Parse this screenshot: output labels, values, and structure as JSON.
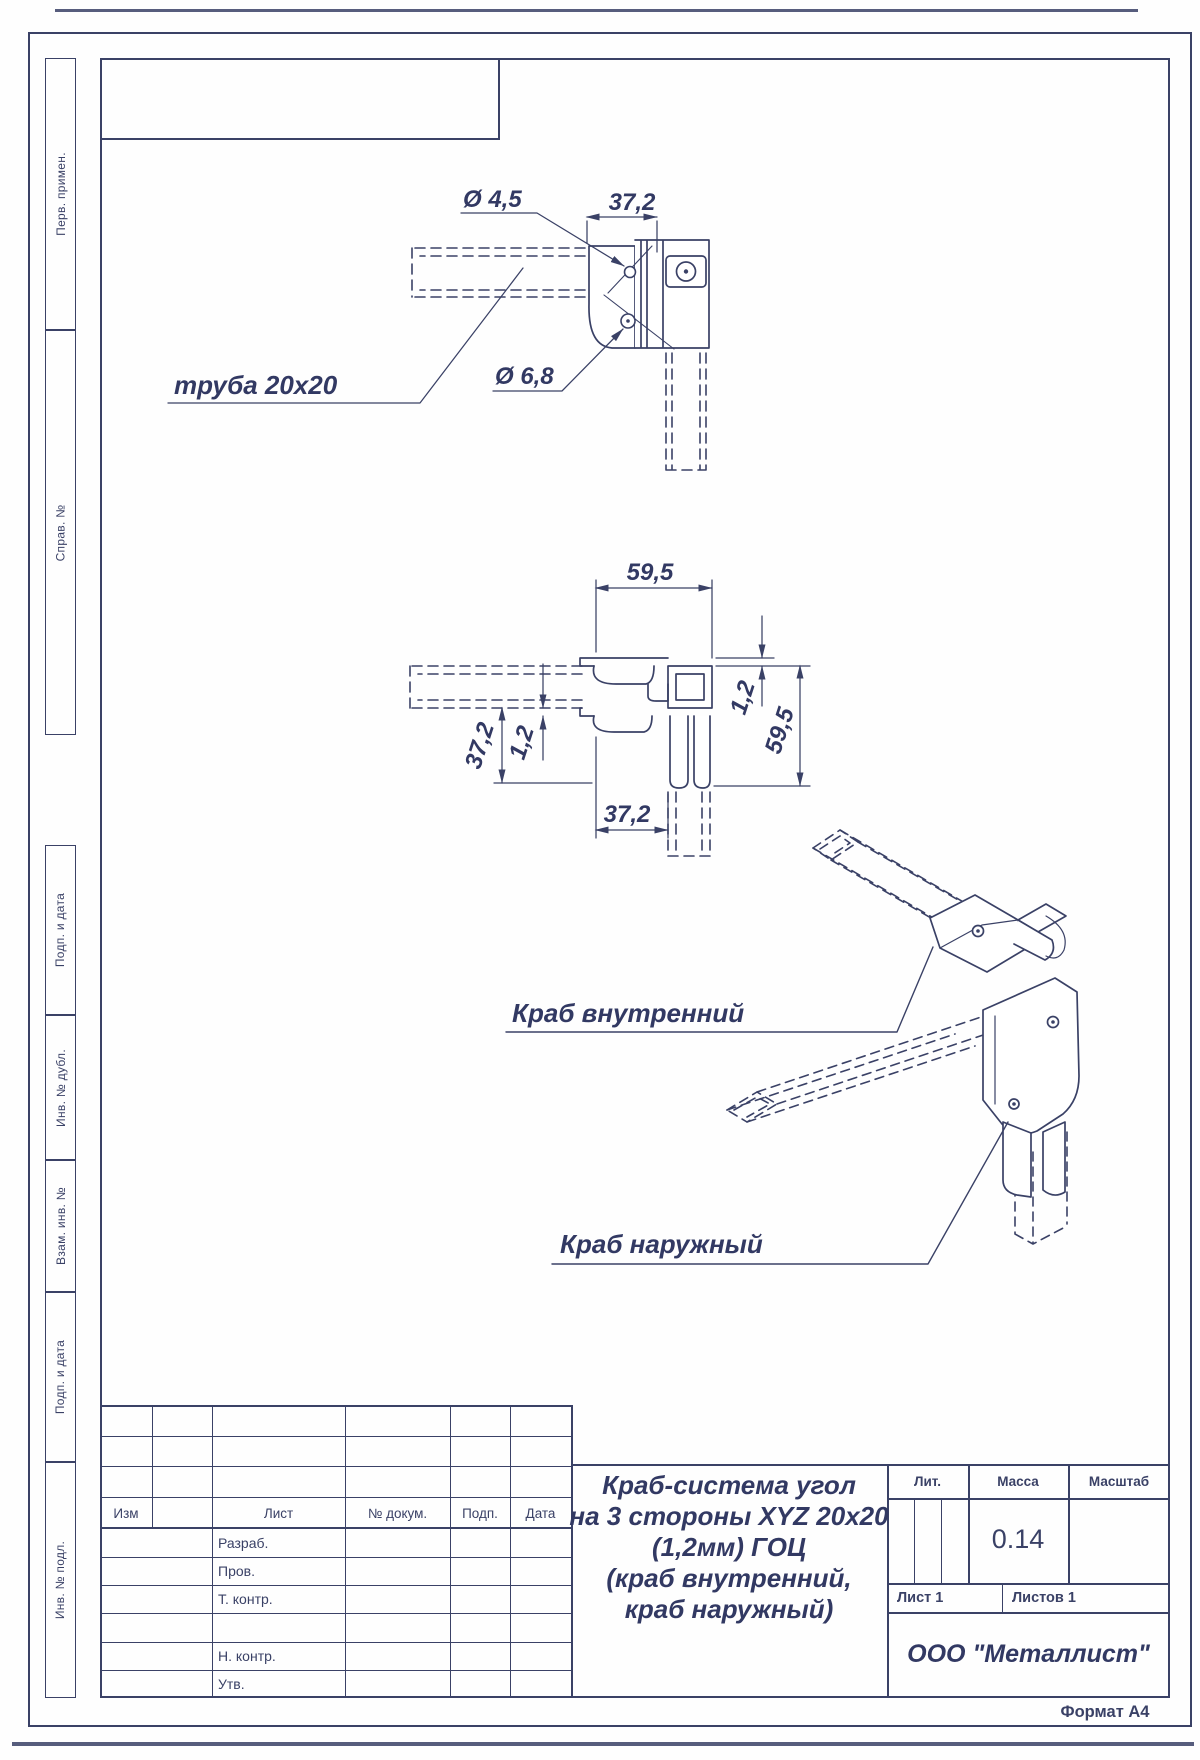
{
  "colors": {
    "ink": "#3a4166"
  },
  "margin_labels": [
    "Перв. примен.",
    "Справ. №",
    "Подп. и дата",
    "Инв. № дубл.",
    "Взам. инв. №",
    "Подп. и дата",
    "Инв. № подл."
  ],
  "views": {
    "top": {
      "dim_hole_small": "Ø 4,5",
      "dim_width": "37,2",
      "dim_hole_large": "Ø 6,8",
      "tube_label": "труба 20x20"
    },
    "section": {
      "dim_top": "59,5",
      "dim_right_thickness": "1,2",
      "dim_right_height": "59,5",
      "dim_left_height": "37,2",
      "dim_left_thickness": "1,2",
      "dim_bottom": "37,2"
    },
    "iso": {
      "label_inner": "Краб внутренний",
      "label_outer": "Краб наружный"
    }
  },
  "title_block": {
    "rev_headers": [
      "Изм",
      "Лист",
      "№ докум.",
      "Подп.",
      "Дата"
    ],
    "staff_labels": [
      "Разраб.",
      "Пров.",
      "Т. контр.",
      "Н. контр.",
      "Утв."
    ],
    "title_lines": [
      "Краб-система угол",
      "на 3 стороны XYZ 20x20",
      "(1,2мм) ГОЦ",
      "(краб внутренний,",
      "краб наружный)"
    ],
    "lit": "Лит.",
    "mass": "Масса",
    "scale": "Масштаб",
    "mass_value": "0.14",
    "sheet": "Лист 1",
    "sheets": "Листов 1",
    "company": "ООО \"Металлист\"",
    "format": "Формат А4"
  }
}
